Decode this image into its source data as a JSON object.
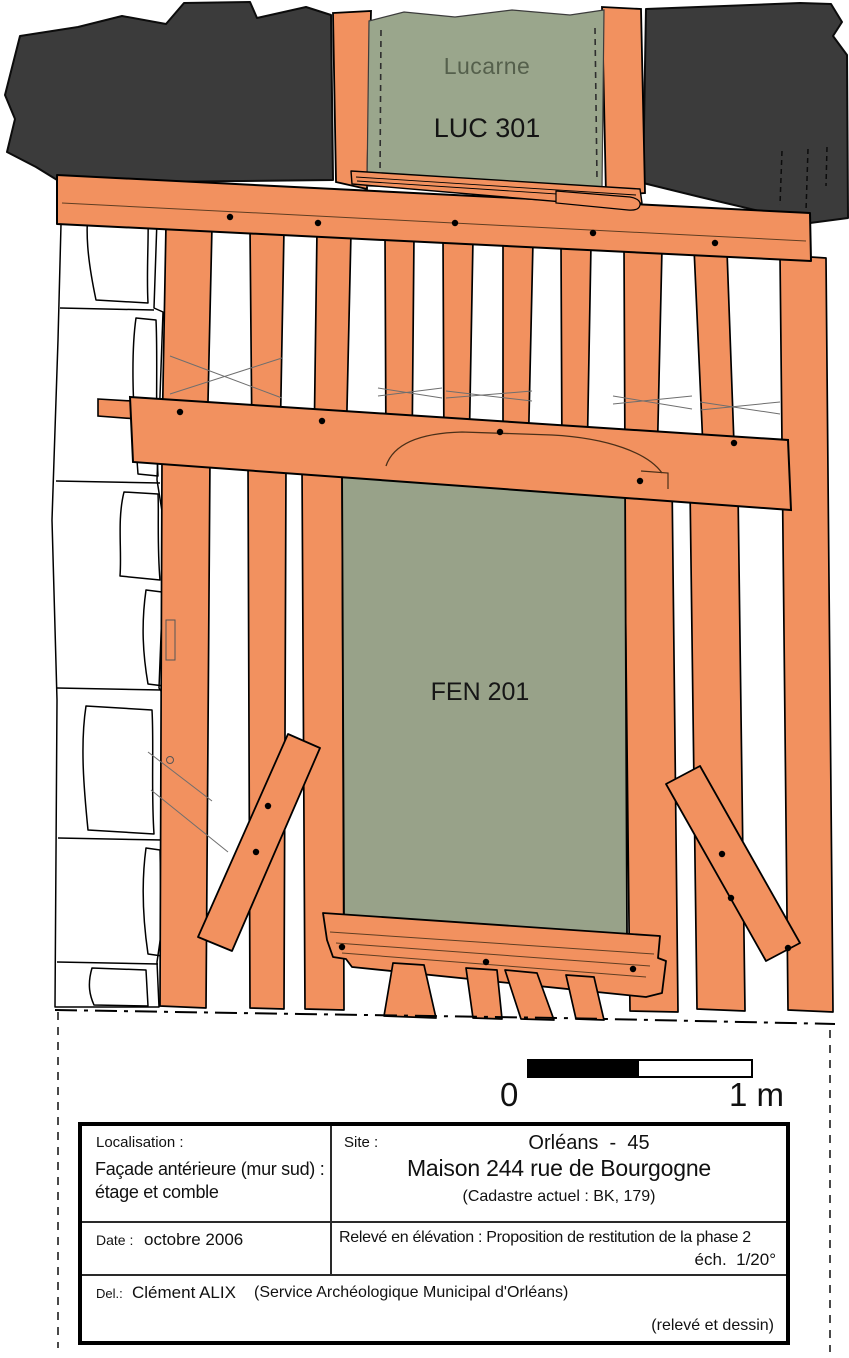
{
  "drawing": {
    "labels": {
      "lucarne_title": "Lucarne",
      "lucarne_id": "LUC 301",
      "window_id": "FEN 201"
    },
    "colors": {
      "timber": "#F2915F",
      "opening_green": "#98A289",
      "roof_dark": "#3B3B3B",
      "infill_white": "#FFFFFF",
      "outline": "#000000",
      "lucarne_text": "#55604C"
    }
  },
  "scale_bar": {
    "zero_label": "0",
    "one_label": "1 m"
  },
  "title_block": {
    "localisation": {
      "label": "Localisation :",
      "value_line1": "Façade antérieure (mur sud) :",
      "value_line2": "étage et comble"
    },
    "site": {
      "label": "Site :",
      "city": "Orléans  -  45",
      "building": "Maison 244 rue de Bourgogne",
      "cadastre": "(Cadastre actuel : BK, 179)"
    },
    "date": {
      "label": "Date :",
      "value": "octobre 2006"
    },
    "releve": {
      "line1": "Relevé en élévation : Proposition de restitution de la phase 2",
      "line2": "éch.  1/20°"
    },
    "del": {
      "label": "Del.:",
      "author": "Clément ALIX",
      "service": "(Service Archéologique Municipal d'Orléans)",
      "credit": "(relevé et dessin)"
    }
  }
}
